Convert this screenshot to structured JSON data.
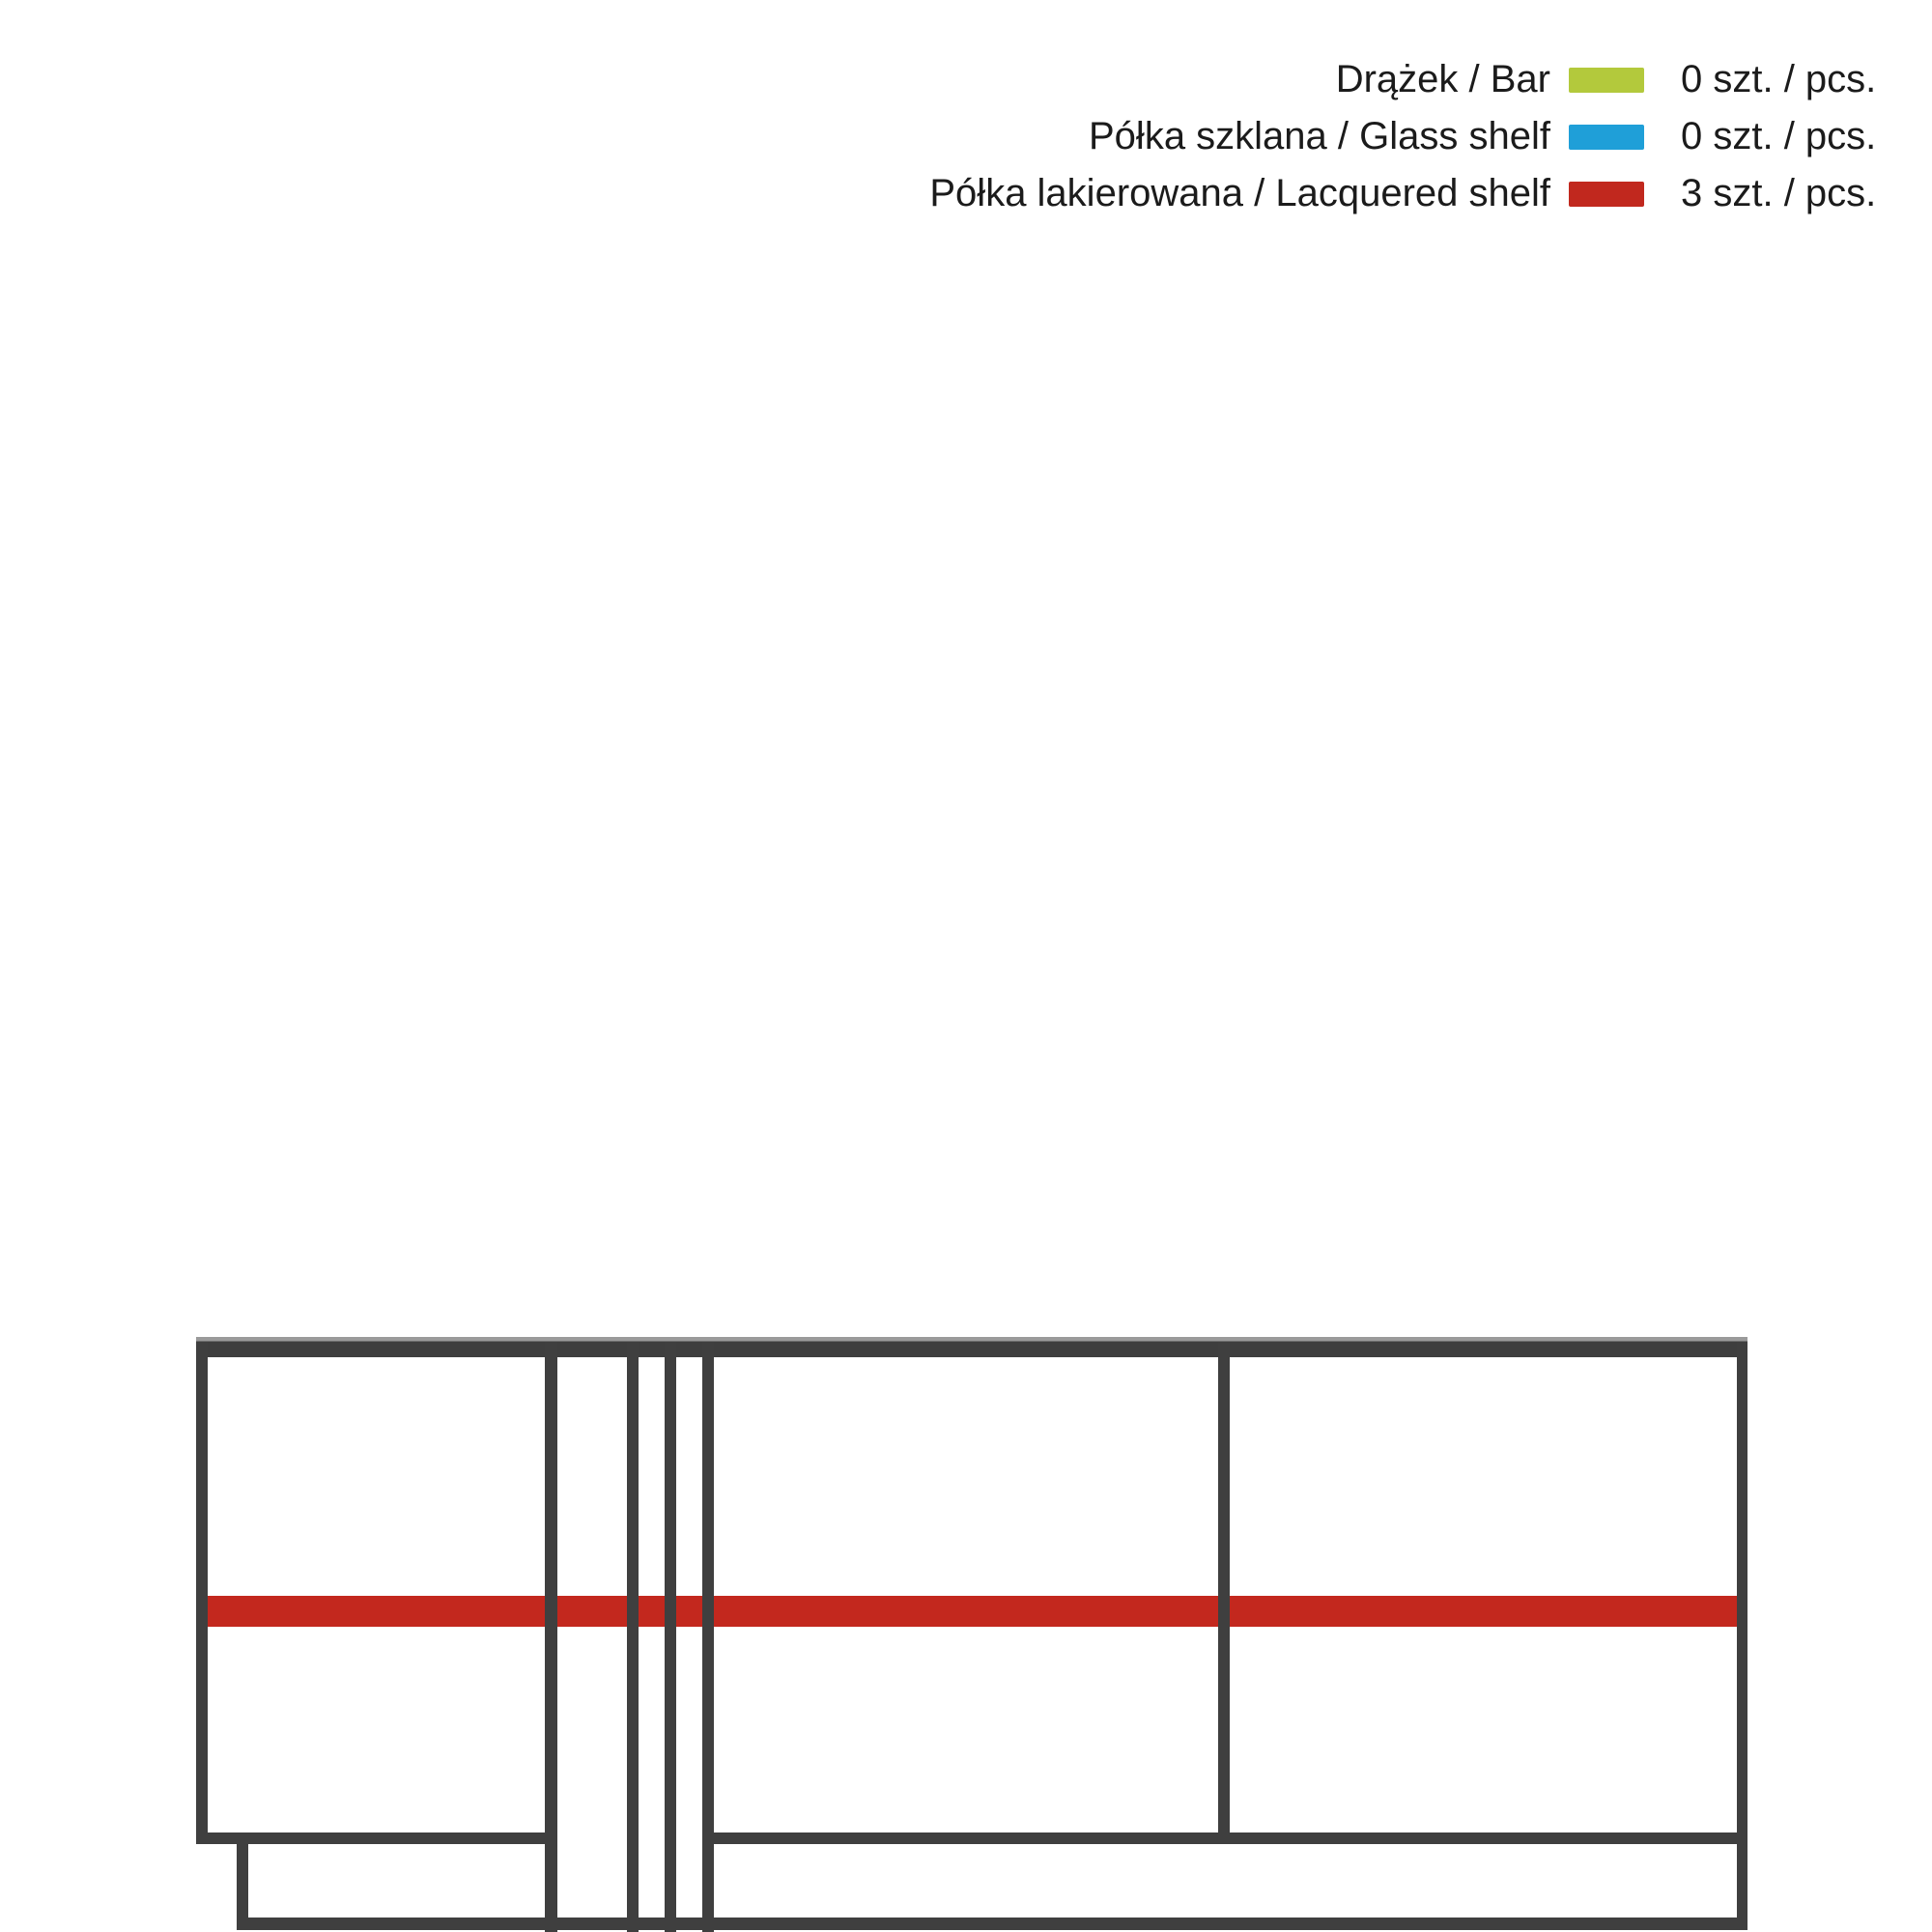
{
  "legend": {
    "rows": [
      {
        "id": "bar",
        "label": "Drążek / Bar",
        "count": "0 szt. / pcs.",
        "color": "#b3c93c"
      },
      {
        "id": "glass-shelf",
        "label": "Półka szklana / Glass shelf",
        "count": "0 szt. / pcs.",
        "color": "#1f9fd8"
      },
      {
        "id": "lacquered-shelf",
        "label": "Półka lakierowana / Lacquered shelf",
        "count": "3 szt. / pcs.",
        "color": "#c1281e"
      }
    ]
  },
  "diagram": {
    "type": "wardrobe-front-elevation",
    "lacquered_shelf_count": 3,
    "shelf_color": "#c3281e",
    "line_color": "#3f3f3f"
  }
}
